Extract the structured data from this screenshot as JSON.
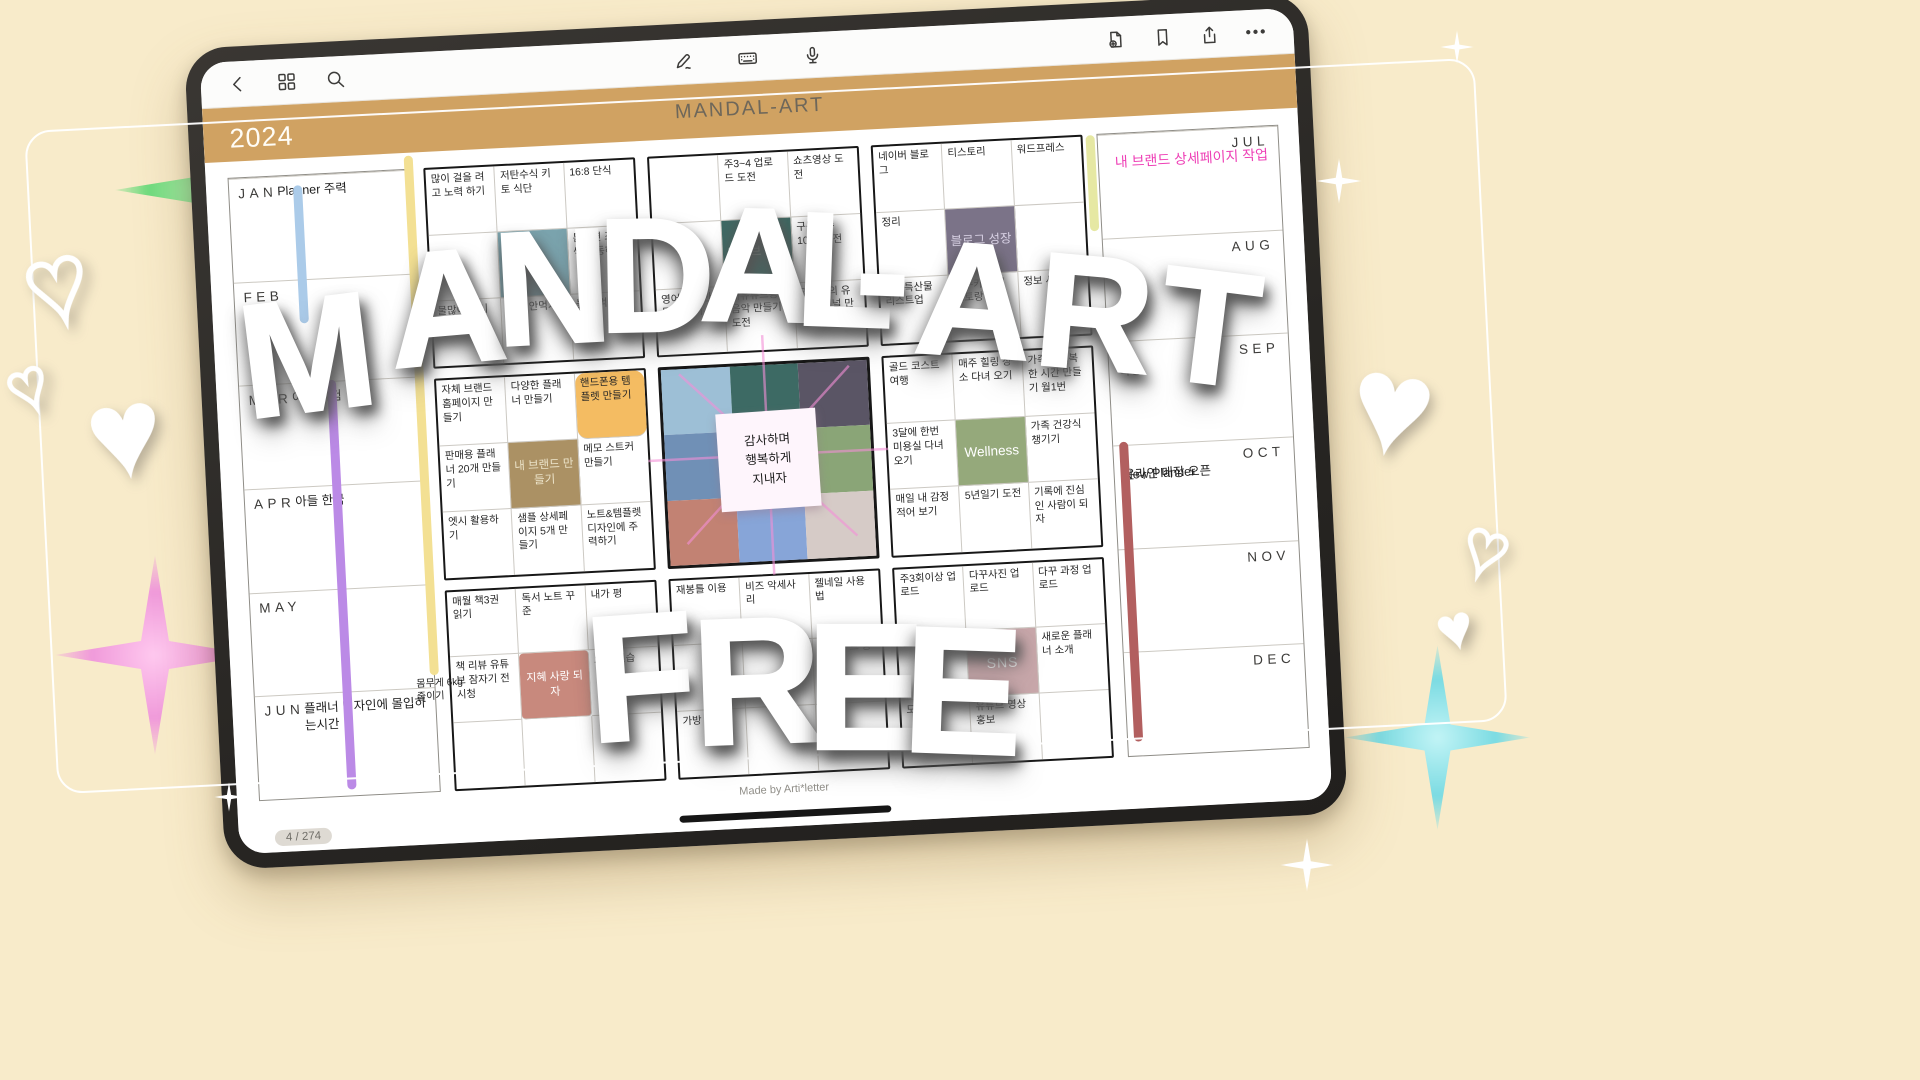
{
  "toolbar": {
    "left_icons": [
      "back",
      "page-thumbnails",
      "search"
    ],
    "center_icons": [
      "pen",
      "keyboard",
      "microphone"
    ],
    "right_icons": [
      "add-page",
      "bookmark",
      "share",
      "more"
    ],
    "more_label": "•••"
  },
  "header": {
    "title": "MANDAL-ART",
    "year": "2024"
  },
  "months_left": [
    {
      "label": "JAN",
      "entries": [
        "Planner 주력"
      ]
    },
    {
      "label": "FEB",
      "entries": []
    },
    {
      "label": "MAR",
      "entries": [
        "아들 시험"
      ]
    },
    {
      "label": "APR",
      "entries": [
        "아들 한국"
      ]
    },
    {
      "label": "MAY",
      "entries": []
    },
    {
      "label": "JUN",
      "entries": [
        "플래너 디자인에 몰입하는시간"
      ]
    }
  ],
  "months_right": [
    {
      "label": "JUL",
      "entries": [
        "내 브랜드 상세페이지 작업"
      ]
    },
    {
      "label": "AUG",
      "entries": []
    },
    {
      "label": "SEP",
      "entries": [
        "여행"
      ]
    },
    {
      "label": "OCT",
      "entries": [
        "New Planner",
        "온라인 매장 오픈"
      ]
    },
    {
      "label": "NOV",
      "entries": []
    },
    {
      "label": "DEC",
      "entries": []
    }
  ],
  "timeline": {
    "weight_label": "몸무게 6kg 줄이기"
  },
  "grids": {
    "health": {
      "cells": [
        "많이 걸을 려고 노력 하기",
        "저탄수식 키토 식단",
        "16:8 단식",
        "",
        "건강",
        "틈나면 조금씩 운동하기",
        "물많이 마시기",
        "과자 안먹기",
        "늦게 먹지 말기"
      ]
    },
    "youtube": {
      "cells": [
        "",
        "주3~4 업로드 도전",
        "쇼츠영상 도전",
        "",
        "유튜브 성장",
        "구독자수 1000 도전",
        "영어댓글 만들어 두기",
        "내유튜브용 음악 만들기 도전",
        "또하나의 유튜브 채널 만들기"
      ]
    },
    "blog": {
      "cells": [
        "네이버 블로그",
        "티스토리",
        "워드프레스",
        "정리",
        "블로그 성장",
        "",
        "호주특산물 리스트업",
        "호주카페 레스토랑",
        "정보 사이트"
      ]
    },
    "brand": {
      "cells": [
        "자체 브랜드 홈페이지 만들기",
        "다양한 플래너 만들기",
        "핸드폰용 템플렛 만들기",
        "판매용 플래너 20개 만들기",
        "내 브랜드 만들기",
        "메모 스트커 만들기",
        "엣시 활용하기",
        "샘플 상세페이지 5개 만들기",
        "노트&템플렛 디자인에 주력하기"
      ]
    },
    "center": {
      "colors": [
        "#9dbfd6",
        "#3d6a64",
        "#5a5565",
        "#7090b6",
        "#a9b6a4",
        "#8aa577",
        "#c28273",
        "#87a5d8",
        "#d6cbc7"
      ],
      "sticky_note": "감사하며\n행복하게\n지내자"
    },
    "wellness": {
      "cells": [
        "골드 코스트 여행",
        "매주 힐링 장소 다녀 오기",
        "가족과 행복한 시간 만들기 월1번",
        "3달에 한번 미용실 다녀오기",
        "Wellness",
        "가족 건강식 챙기기",
        "매일 내 감정 적어 보기",
        "5년일기 도전",
        "기록에 진심인 사람이 되자"
      ]
    },
    "reading": {
      "cells": [
        "매월 책3권 읽기",
        "독서 노트 꾸준",
        "내가 평",
        "책 리뷰 유튜브 잠자기 전 시청",
        "지혜 사랑 되자",
        "으로 연습",
        "",
        "",
        ""
      ]
    },
    "hobby": {
      "cells": [
        "재봉틀 이용",
        "비즈 악세사리",
        "젤네일 사용법",
        "",
        "",
        "포크리 트 공부",
        "가방 만들기",
        "",
        ""
      ]
    },
    "sns": {
      "cells": [
        "주3회이상 업로드",
        "다꾸사진 업로드",
        "다꾸 과정 업로드",
        "로드",
        "SNS",
        "새로운 플래너 소개",
        "도전",
        "유튜브 영상 홍보",
        ""
      ]
    }
  },
  "footer": {
    "credit": "Made by Arti*letter",
    "page": "4 / 274"
  },
  "overlay": {
    "title": "MANDAL-ART",
    "free": "FREE",
    "title_letters": [
      "M",
      "A",
      "N",
      "D",
      "A",
      "L",
      "-",
      "A",
      "R",
      "T"
    ],
    "free_letters": [
      "F",
      "R",
      "E",
      "E"
    ]
  },
  "colors": {
    "background": "#f8ebca",
    "header_band": "#d0a262",
    "bezel": "#2b2927",
    "line_blue": "#abcbe9",
    "line_yellow": "#f3e093",
    "line_purple": "#bb8ae6",
    "line_lime": "#e6e8a3",
    "line_maroon": "#b25f5f",
    "highlight_orange": "#f4bc62",
    "pink_text": "#ee3fb6"
  }
}
